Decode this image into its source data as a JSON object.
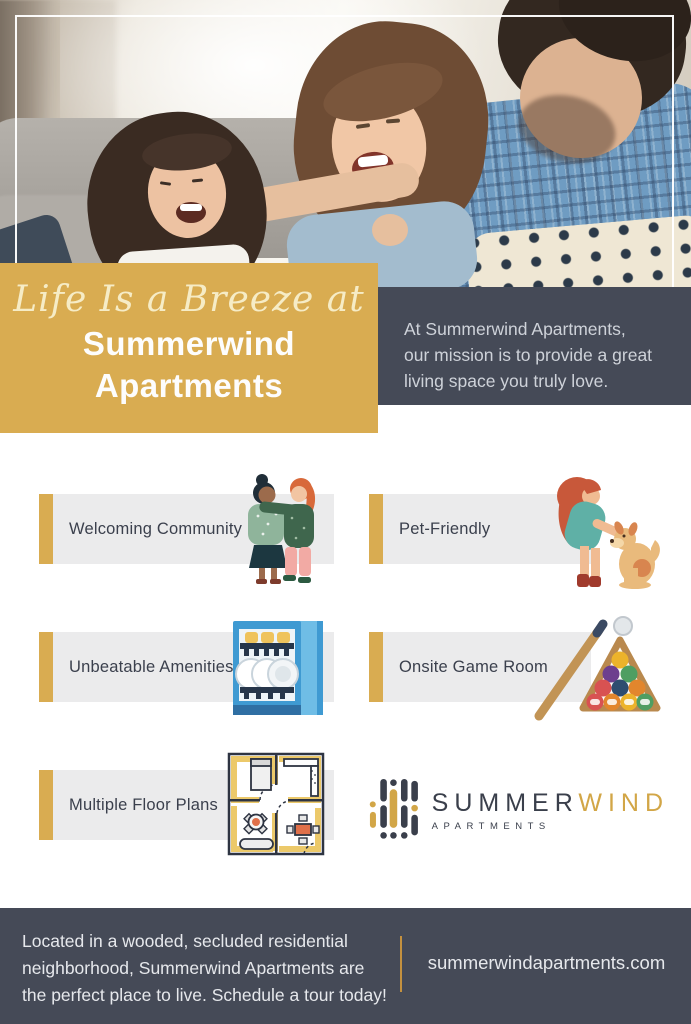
{
  "hero": {
    "script_line": "Life Is a Breeze at",
    "title_lines": [
      "Summerwind",
      "Apartments"
    ],
    "mission_lines": [
      "At Summerwind Apartments,",
      "our mission is to provide a great",
      "living space you truly love."
    ]
  },
  "features": [
    {
      "label": "Welcoming Community",
      "icon": "community-illustration"
    },
    {
      "label": "Pet-Friendly",
      "icon": "pet-illustration"
    },
    {
      "label": "Unbeatable Amenities",
      "icon": "dishwasher-illustration"
    },
    {
      "label": "Onsite Game Room",
      "icon": "billiards-illustration"
    },
    {
      "label": "Multiple Floor Plans",
      "icon": "floorplan-illustration"
    }
  ],
  "logo": {
    "part1": "SUMMER",
    "part2": "WIND",
    "subtitle": "APARTMENTS"
  },
  "footer": {
    "message_lines": [
      "Located in a wooded, secluded residential",
      "neighborhood, Summerwind Apartments are",
      "the perfect place to live. Schedule a tour today!"
    ],
    "website": "summerwindapartments.com"
  },
  "colors": {
    "gold": "#d9ac51",
    "slate": "#454a57",
    "bar_gray": "#ebebec",
    "cream_script": "#f6ecc6",
    "footer_divider_gold": "#c4913f",
    "logo_dark": "#3a3f4b",
    "logo_gold": "#d2a647"
  }
}
